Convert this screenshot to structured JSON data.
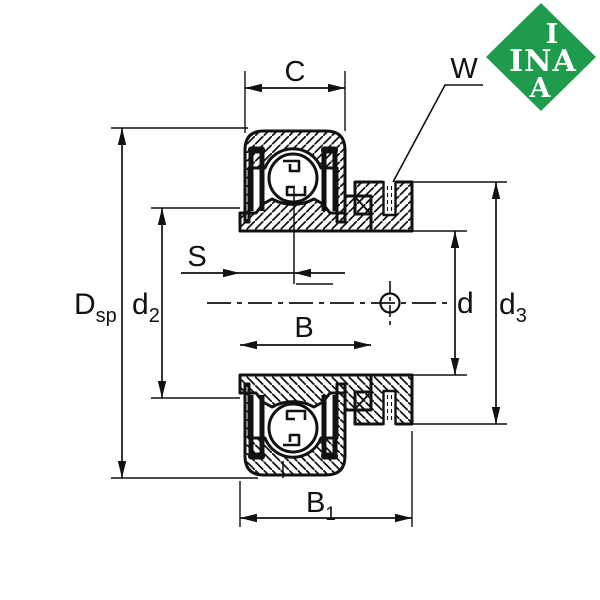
{
  "logo": {
    "top": "I",
    "middle": "INA",
    "bottom": "A"
  },
  "dimensions": {
    "C": "C",
    "W": "W",
    "S": "S",
    "B": "B",
    "B1_main": "B",
    "B1_sub": "1",
    "Dsp_main": "D",
    "Dsp_sub": "sp",
    "d2_main": "d",
    "d2_sub": "2",
    "d": "d",
    "d3_main": "d",
    "d3_sub": "3"
  },
  "colors": {
    "line": "#111111",
    "background": "#ffffff",
    "logo_green": "#1f9b4e",
    "logo_text": "#ffffff"
  }
}
